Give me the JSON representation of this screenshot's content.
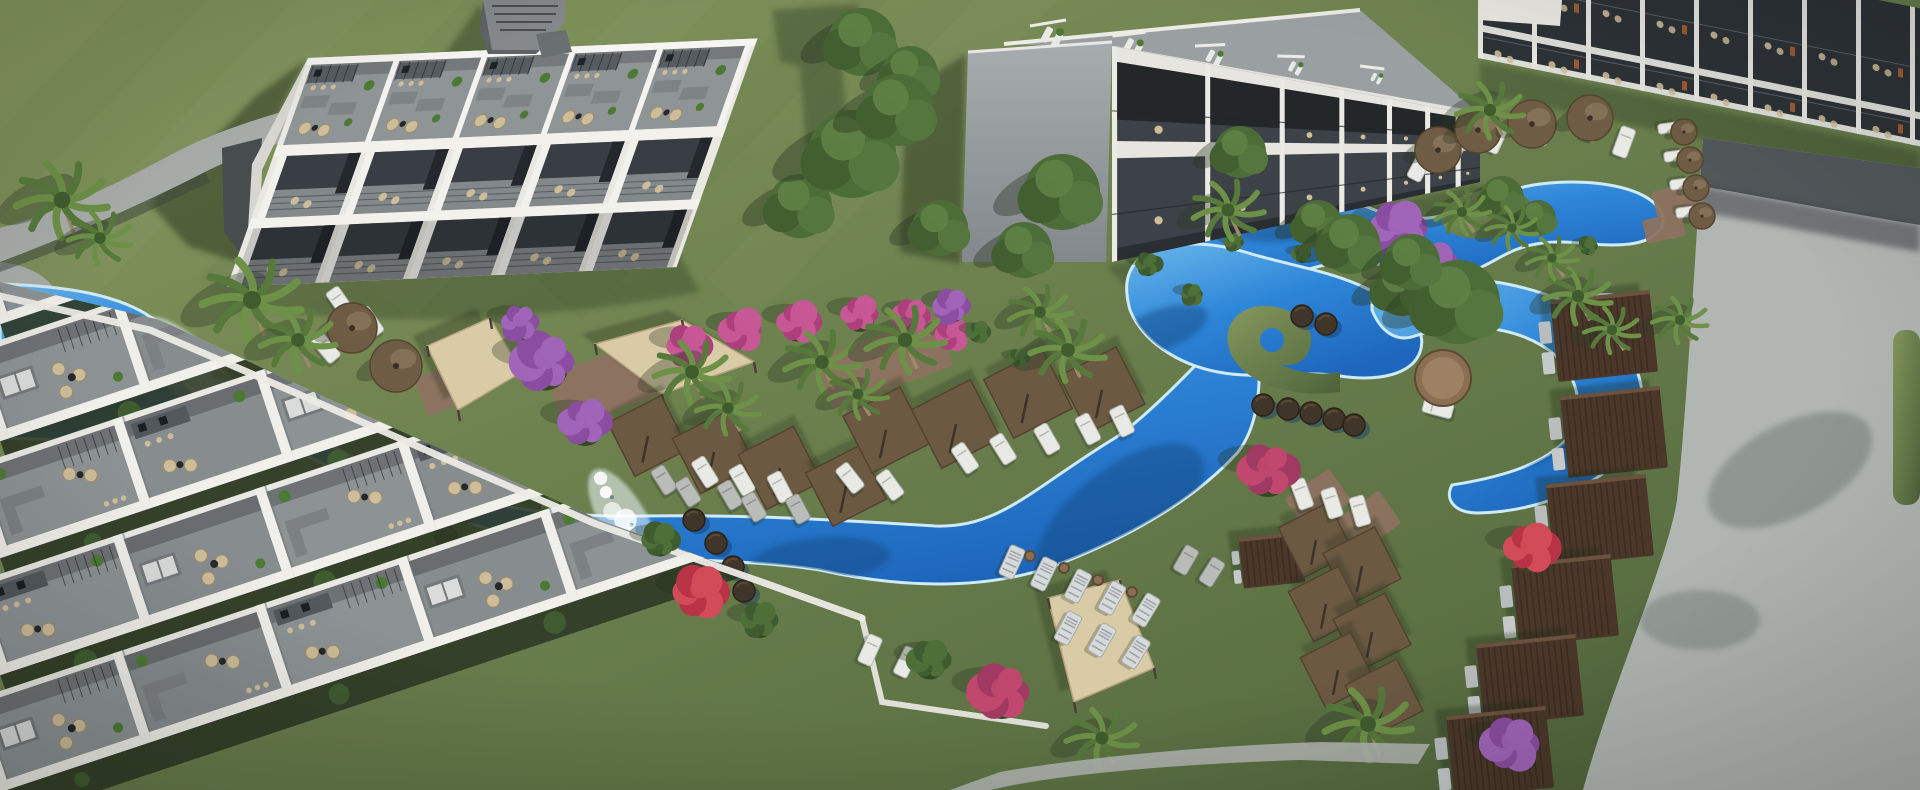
{
  "scene": {
    "title": "Aerial 3D architectural render of a resort residence complex with winding lagoon pools, gardens and sun decks",
    "type": "architectural-visualization",
    "view": "aerial-oblique",
    "time_of_day": "midday"
  },
  "palette": {
    "grass_light": "#87985f",
    "grass_mid": "#6e8150",
    "grass_dark": "#4d6038",
    "water_light": "#6ab7ea",
    "water_mid": "#2e86d8",
    "water_deep": "#1d66bb",
    "foam": "#eef8fd",
    "white_wall": "#f2f1ec",
    "wall_shade": "#d8d7d1",
    "facade_dark": "#383e44",
    "terrace_gray": "#878c8f",
    "kitchen_dark": "#53585c",
    "stone_light": "#b4b8b4",
    "stone_dark": "#52575a",
    "umbrella_brown": "#6e5c44",
    "shade_brown": "#6b5942",
    "cabana_brown": "#4a372a",
    "sail_beige": "#d9cba6",
    "chair_beige": "#cdbd9a",
    "pad_brick": "#8d7260",
    "bush_purple": "#8a4da0",
    "bush_magenta": "#ad3f7d",
    "bush_red": "#b83346",
    "palm_green": "#6d9147",
    "tree_green": "#4c6c38",
    "shadow_green": "#25331f"
  },
  "objects": {
    "palms": [
      [
        62,
        200,
        46
      ],
      [
        100,
        238,
        32
      ],
      [
        252,
        300,
        50
      ],
      [
        298,
        340,
        38
      ],
      [
        692,
        372,
        38
      ],
      [
        728,
        408,
        32
      ],
      [
        822,
        362,
        38
      ],
      [
        858,
        394,
        30
      ],
      [
        905,
        340,
        40
      ],
      [
        1040,
        312,
        32
      ],
      [
        1068,
        350,
        38
      ],
      [
        1228,
        210,
        36
      ],
      [
        1490,
        110,
        34
      ],
      [
        1462,
        212,
        28
      ],
      [
        1512,
        228,
        26
      ],
      [
        1578,
        296,
        34
      ],
      [
        1612,
        330,
        28
      ],
      [
        1552,
        258,
        26
      ],
      [
        1680,
        320,
        28
      ],
      [
        1368,
        724,
        44
      ],
      [
        1102,
        738,
        36
      ]
    ],
    "trees": [
      [
        862,
        42,
        34
      ],
      [
        910,
        74,
        28
      ],
      [
        800,
        206,
        32
      ],
      [
        852,
        154,
        44
      ],
      [
        898,
        110,
        36
      ],
      [
        940,
        228,
        28
      ],
      [
        1062,
        192,
        38
      ],
      [
        1024,
        250,
        28
      ],
      [
        1240,
        152,
        26
      ],
      [
        1318,
        224,
        24
      ],
      [
        1350,
        244,
        30
      ],
      [
        1402,
        288,
        28
      ],
      [
        1458,
        302,
        42
      ],
      [
        1412,
        262,
        28
      ],
      [
        1502,
        198,
        22
      ],
      [
        1538,
        218,
        18
      ]
    ],
    "bushes": [
      [
        545,
        362,
        38,
        "purple"
      ],
      [
        585,
        422,
        32,
        "purple"
      ],
      [
        520,
        322,
        24,
        "purple"
      ],
      [
        688,
        346,
        28,
        "magenta"
      ],
      [
        742,
        330,
        26,
        "magenta"
      ],
      [
        798,
        322,
        26,
        "magenta"
      ],
      [
        860,
        314,
        24,
        "magenta"
      ],
      [
        912,
        316,
        22,
        "magenta"
      ],
      [
        952,
        334,
        20,
        "magenta"
      ],
      [
        1398,
        228,
        34,
        "purple"
      ],
      [
        1434,
        264,
        26,
        "purple"
      ],
      [
        952,
        306,
        22,
        "purple"
      ],
      [
        700,
        592,
        32,
        "red"
      ],
      [
        1002,
        692,
        36,
        "redpurple"
      ],
      [
        1268,
        470,
        36,
        "redpurple"
      ],
      [
        1530,
        548,
        32,
        "red"
      ],
      [
        1512,
        744,
        34,
        "purple"
      ],
      [
        660,
        540,
        22,
        "green"
      ],
      [
        760,
        620,
        24,
        "green"
      ],
      [
        930,
        660,
        26,
        "green"
      ],
      [
        1148,
        264,
        16,
        "green"
      ],
      [
        1192,
        294,
        14,
        "green"
      ],
      [
        1234,
        242,
        12,
        "green"
      ],
      [
        1420,
        300,
        14,
        "green"
      ],
      [
        1302,
        254,
        12,
        "green"
      ],
      [
        1588,
        246,
        12,
        "green"
      ],
      [
        978,
        332,
        14,
        "green"
      ],
      [
        1018,
        358,
        12,
        "green"
      ]
    ],
    "umbrellas": [
      [
        352,
        328,
        25
      ],
      [
        396,
        366,
        26
      ],
      [
        1438,
        150,
        23
      ],
      [
        1478,
        130,
        23
      ],
      [
        1532,
        124,
        24
      ],
      [
        1590,
        118,
        23
      ],
      [
        1684,
        132,
        13
      ],
      [
        1690,
        160,
        13
      ],
      [
        1696,
        188,
        13
      ],
      [
        1702,
        216,
        13
      ]
    ],
    "loungers_white": [
      [
        340,
        302,
        -35
      ],
      [
        370,
        322,
        -35
      ],
      [
        326,
        348,
        -40
      ],
      [
        705,
        472,
        -32
      ],
      [
        742,
        480,
        -30
      ],
      [
        780,
        487,
        -28
      ],
      [
        850,
        478,
        -38
      ],
      [
        890,
        485,
        -36
      ],
      [
        965,
        458,
        -34
      ],
      [
        1003,
        449,
        -32
      ],
      [
        1047,
        439,
        -30
      ],
      [
        1088,
        429,
        -28
      ],
      [
        1122,
        421,
        -26
      ],
      [
        1420,
        166,
        28
      ],
      [
        1456,
        148,
        26
      ],
      [
        1496,
        138,
        24
      ],
      [
        1544,
        130,
        22
      ],
      [
        1592,
        126,
        20
      ],
      [
        1624,
        142,
        20
      ],
      [
        1302,
        494,
        -20
      ],
      [
        1332,
        503,
        -18
      ],
      [
        1360,
        511,
        -16
      ],
      [
        870,
        650,
        24
      ],
      [
        906,
        662,
        26
      ],
      [
        1438,
        408,
        -75
      ]
    ],
    "loungers_small": [
      [
        1668,
        128,
        82
      ],
      [
        1674,
        156,
        82
      ],
      [
        1680,
        184,
        82
      ],
      [
        1686,
        212,
        82
      ]
    ],
    "loungers_gray": [
      [
        664,
        480,
        -32
      ],
      [
        688,
        492,
        -32
      ],
      [
        730,
        495,
        -30
      ],
      [
        754,
        507,
        -30
      ],
      [
        798,
        509,
        -28
      ],
      [
        1186,
        560,
        30
      ],
      [
        1212,
        572,
        32
      ]
    ],
    "loungers_striped": [
      [
        1012,
        562,
        24
      ],
      [
        1044,
        574,
        26
      ],
      [
        1078,
        586,
        27
      ],
      [
        1112,
        598,
        29
      ],
      [
        1146,
        610,
        31
      ],
      [
        1068,
        628,
        28
      ],
      [
        1102,
        640,
        30
      ],
      [
        1136,
        652,
        32
      ]
    ],
    "shade_squares": [
      [
        648,
        436,
        60
      ],
      [
        714,
        452,
        62
      ],
      [
        780,
        468,
        62
      ],
      [
        846,
        486,
        60
      ],
      [
        886,
        430,
        64
      ],
      [
        956,
        424,
        66
      ],
      [
        1028,
        394,
        66
      ],
      [
        1102,
        390,
        64
      ],
      [
        1316,
        540,
        56
      ],
      [
        1362,
        566,
        58
      ],
      [
        1326,
        604,
        56
      ],
      [
        1372,
        632,
        58
      ],
      [
        1338,
        670,
        56
      ],
      [
        1384,
        698,
        58
      ]
    ],
    "cabanas": [
      [
        1604,
        336,
        1
      ],
      [
        1614,
        432,
        1
      ],
      [
        1600,
        520,
        1
      ],
      [
        1565,
        600,
        1
      ],
      [
        1530,
        680,
        1
      ],
      [
        1500,
        752,
        1
      ],
      [
        1272,
        560,
        0.62
      ]
    ],
    "stepping_stones": [
      [
        450,
        468
      ],
      [
        477,
        486
      ],
      [
        463,
        512
      ],
      [
        446,
        537
      ],
      [
        481,
        551
      ],
      [
        508,
        564
      ],
      [
        694,
        520
      ],
      [
        716,
        543
      ],
      [
        733,
        567
      ],
      [
        744,
        591
      ],
      [
        1263,
        405
      ],
      [
        1288,
        409
      ],
      [
        1311,
        413
      ],
      [
        1334,
        419
      ],
      [
        1354,
        425
      ],
      [
        1302,
        316
      ],
      [
        1326,
        324
      ]
    ],
    "sails": [
      {
        "pts": "427,346 490,318 522,372 458,410"
      },
      {
        "pts": "595,344 682,320 754,362 662,394"
      },
      {
        "pts": "1048,598 1120,580 1154,668 1074,702"
      }
    ],
    "pads": [
      [
        612,
        382,
        120,
        56,
        -20
      ],
      [
        884,
        362,
        128,
        54,
        -20
      ],
      [
        452,
        386,
        66,
        40,
        -20
      ],
      [
        1100,
        660,
        72,
        44,
        -18
      ],
      [
        1676,
        200,
        44,
        26,
        -12
      ],
      [
        1664,
        228,
        40,
        24,
        -12
      ],
      [
        1318,
        500,
        54,
        40,
        -35
      ],
      [
        1368,
        522,
        54,
        40,
        -35
      ]
    ],
    "tables": [
      [
        1443,
        378,
        28
      ],
      [
        1030,
        556,
        5
      ],
      [
        1064,
        568,
        5
      ],
      [
        1098,
        580,
        5
      ],
      [
        1132,
        592,
        5
      ]
    ],
    "foams": [
      {
        "x1": 152,
        "y1": 330,
        "x2": 232,
        "y2": 414,
        "n": 9,
        "r": 13
      },
      {
        "x1": 600,
        "y1": 480,
        "x2": 648,
        "y2": 562,
        "n": 7,
        "r": 11
      }
    ],
    "water_shadows": [
      [
        1120,
        515,
        100,
        46,
        -38
      ],
      [
        820,
        560,
        70,
        22,
        -5
      ],
      [
        70,
        400,
        80,
        26,
        -10
      ],
      [
        1560,
        430,
        50,
        18,
        -40
      ],
      [
        1290,
        225,
        54,
        16,
        -8
      ],
      [
        1160,
        330,
        50,
        20,
        -20
      ]
    ]
  },
  "buildings": {
    "block_a": {
      "roof_units": 5,
      "facade_units": 5,
      "floors": 2
    },
    "block_b": {
      "facade_cells": 7,
      "floors": 2
    },
    "block_c": {
      "cells": 8,
      "floors": 2
    },
    "foreground_rows": {
      "rows": 5,
      "units_per_row": 8
    }
  },
  "pools": {
    "lazy_river": 1,
    "lagoon_lobes": 4,
    "waterfalls": 2,
    "stepping_stone_crossings": 3
  }
}
